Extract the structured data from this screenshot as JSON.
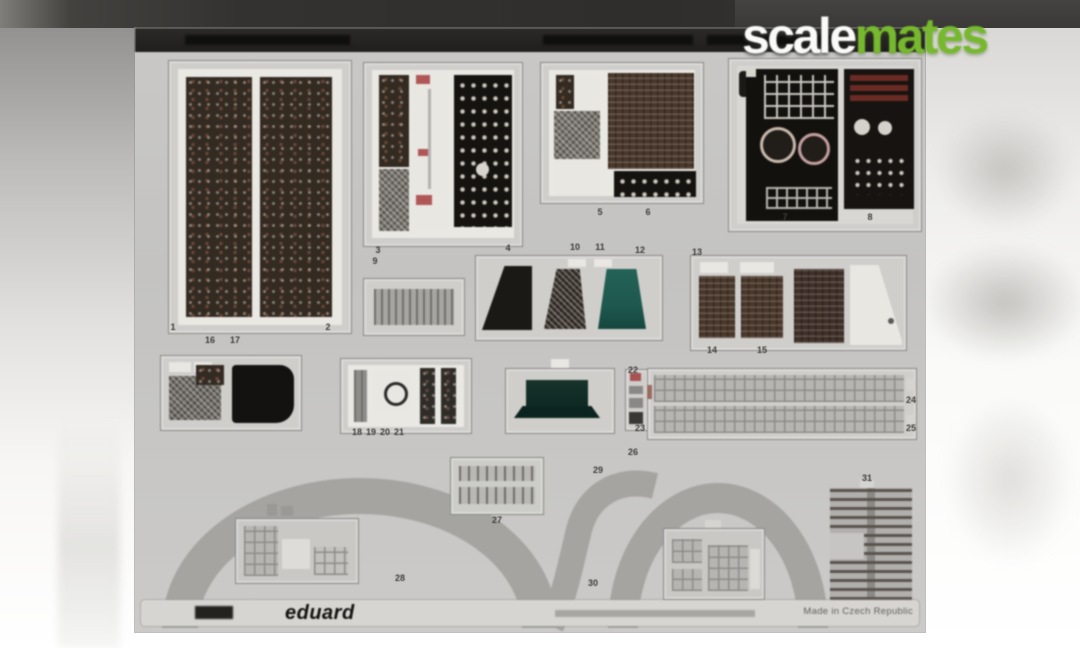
{
  "logo": {
    "scale": "scale",
    "mates": "mates"
  },
  "colors": {
    "accent_green": "#76b82e",
    "topbar": "#343230",
    "sheet_gray": "#c6c5c3"
  },
  "sheet": {
    "footer": {
      "brand": "eduard",
      "made_in": "Made in Czech Republic"
    },
    "part_labels": [
      {
        "n": "1",
        "x": 38,
        "y": 299
      },
      {
        "n": "2",
        "x": 193,
        "y": 299
      },
      {
        "n": "3",
        "x": 243,
        "y": 222
      },
      {
        "n": "4",
        "x": 373,
        "y": 220
      },
      {
        "n": "5",
        "x": 465,
        "y": 184
      },
      {
        "n": "6",
        "x": 513,
        "y": 184
      },
      {
        "n": "7",
        "x": 650,
        "y": 189
      },
      {
        "n": "8",
        "x": 735,
        "y": 189
      },
      {
        "n": "9",
        "x": 240,
        "y": 233
      },
      {
        "n": "10",
        "x": 440,
        "y": 219
      },
      {
        "n": "11",
        "x": 465,
        "y": 219
      },
      {
        "n": "12",
        "x": 505,
        "y": 222
      },
      {
        "n": "13",
        "x": 562,
        "y": 224
      },
      {
        "n": "14",
        "x": 577,
        "y": 322
      },
      {
        "n": "15",
        "x": 627,
        "y": 322
      },
      {
        "n": "16",
        "x": 75,
        "y": 312
      },
      {
        "n": "17",
        "x": 100,
        "y": 312
      },
      {
        "n": "18",
        "x": 222,
        "y": 404
      },
      {
        "n": "19",
        "x": 236,
        "y": 404
      },
      {
        "n": "20",
        "x": 250,
        "y": 404
      },
      {
        "n": "21",
        "x": 264,
        "y": 404
      },
      {
        "n": "22",
        "x": 498,
        "y": 342
      },
      {
        "n": "23",
        "x": 505,
        "y": 400
      },
      {
        "n": "24",
        "x": 776,
        "y": 372
      },
      {
        "n": "25",
        "x": 776,
        "y": 400
      },
      {
        "n": "26",
        "x": 498,
        "y": 424
      },
      {
        "n": "27",
        "x": 362,
        "y": 492
      },
      {
        "n": "28",
        "x": 265,
        "y": 550
      },
      {
        "n": "29",
        "x": 463,
        "y": 442
      },
      {
        "n": "30",
        "x": 458,
        "y": 555
      },
      {
        "n": "31",
        "x": 732,
        "y": 450
      }
    ]
  }
}
